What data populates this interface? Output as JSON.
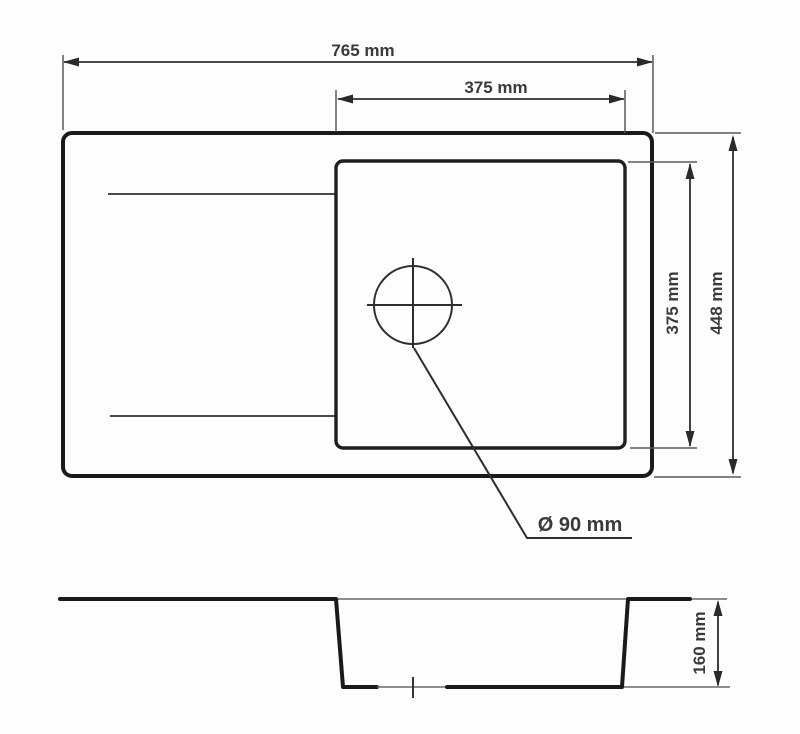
{
  "diagram": {
    "type": "technical-drawing",
    "subject": "kitchen sink with drainer - top view and side profile",
    "units": "mm",
    "colors": {
      "outline": "#1a1a1a",
      "dimension_lines": "#2e2e2e",
      "text": "#3a3a3a",
      "background": "#fdfdfd"
    },
    "dimensions": {
      "overall_width": {
        "label": "765 mm",
        "value": 765
      },
      "basin_width": {
        "label": "375 mm",
        "value": 375
      },
      "basin_depth": {
        "label": "375 mm",
        "value": 375
      },
      "overall_depth": {
        "label": "448 mm",
        "value": 448
      },
      "drain_diameter": {
        "label": "Ø 90 mm",
        "value": 90
      },
      "bowl_height": {
        "label": "160 mm",
        "value": 160
      }
    }
  }
}
